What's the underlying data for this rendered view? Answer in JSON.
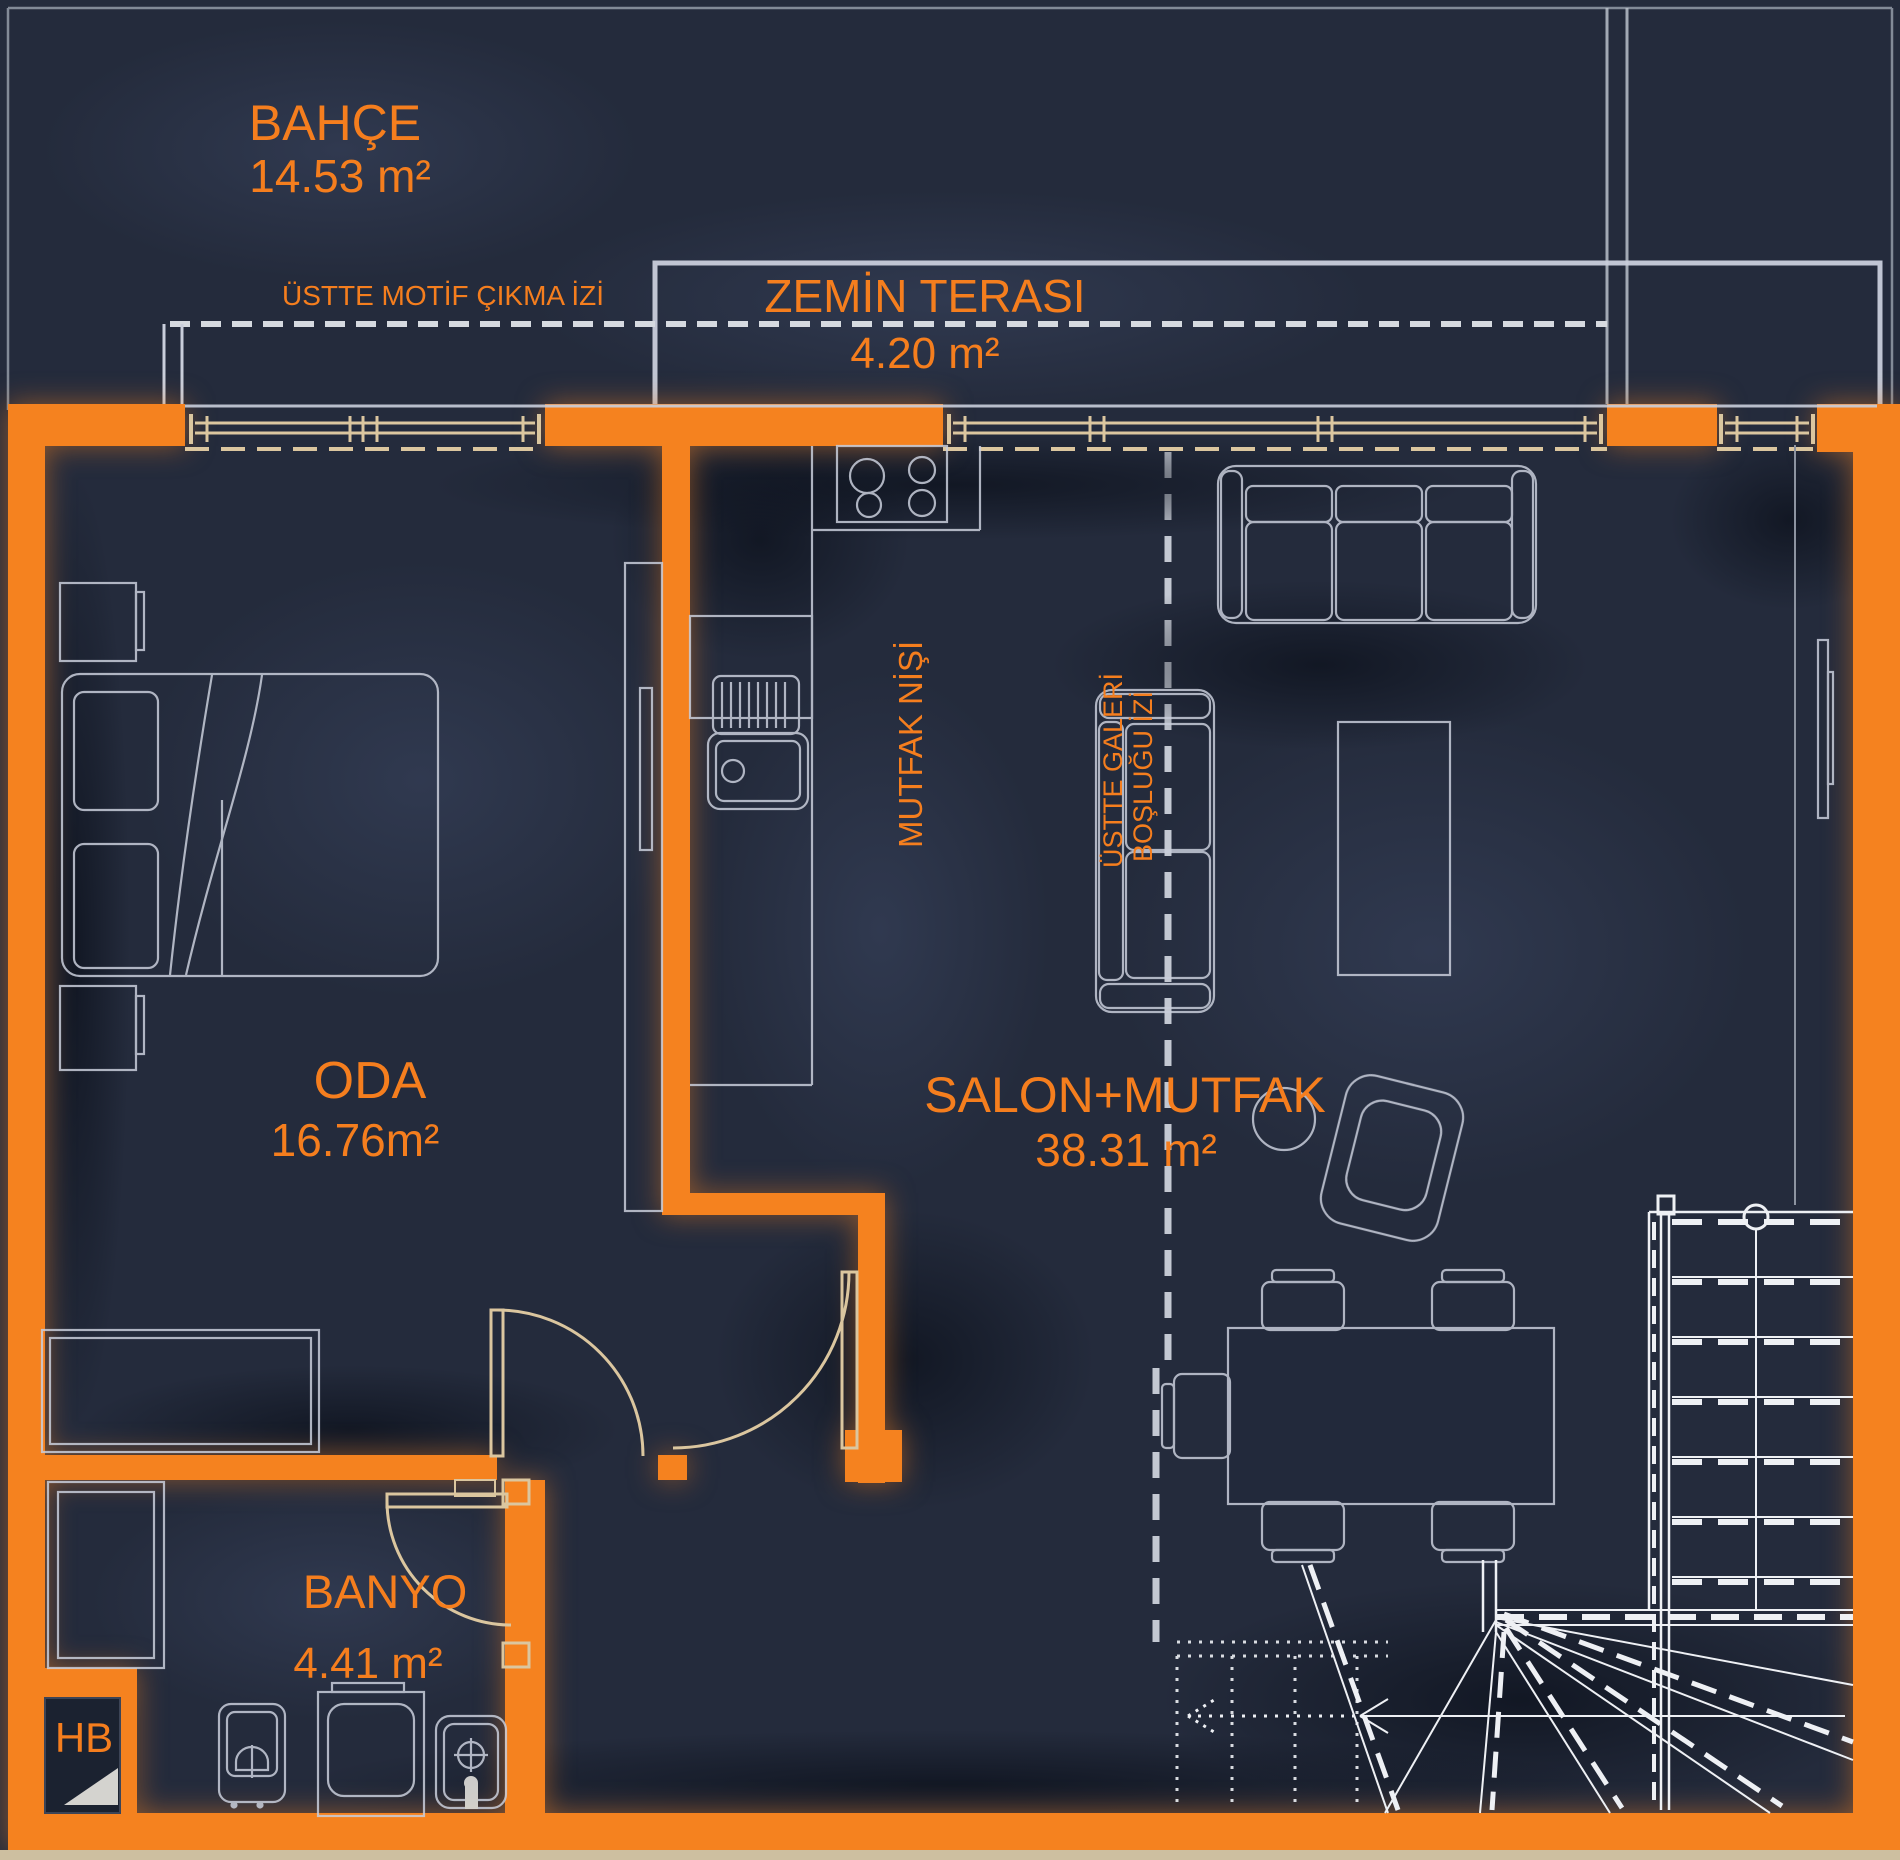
{
  "plan_title": "Zemin Kat Plani",
  "colors": {
    "wall_orange": "#f5821f",
    "background_navy": "#242b3c",
    "line_light_gray": "#c9cedb",
    "line_beige": "#dbc69f",
    "label_orange": "#f57e1e"
  },
  "rooms": {
    "bahce": {
      "name": "BAHÇE",
      "area": "14.53 m²"
    },
    "teras": {
      "name": "ZEMİN TERASI",
      "area": "4.20 m²"
    },
    "oda": {
      "name": "ODA",
      "area": "16.76m²"
    },
    "salon": {
      "name": "SALON+MUTFAK",
      "area": "38.31 m²"
    },
    "banyo": {
      "name": "BANYO",
      "area": "4.41 m²"
    },
    "shaft": {
      "label": "HB"
    }
  },
  "annotations": {
    "motif": "ÜSTTE MOTİF ÇIKMA İZİ",
    "mutfak_nisi": "MUTFAK NİŞİ",
    "galeri_line1": "ÜSTTE GALERİ",
    "galeri_line2": "BOŞLUĞU İZİ"
  }
}
